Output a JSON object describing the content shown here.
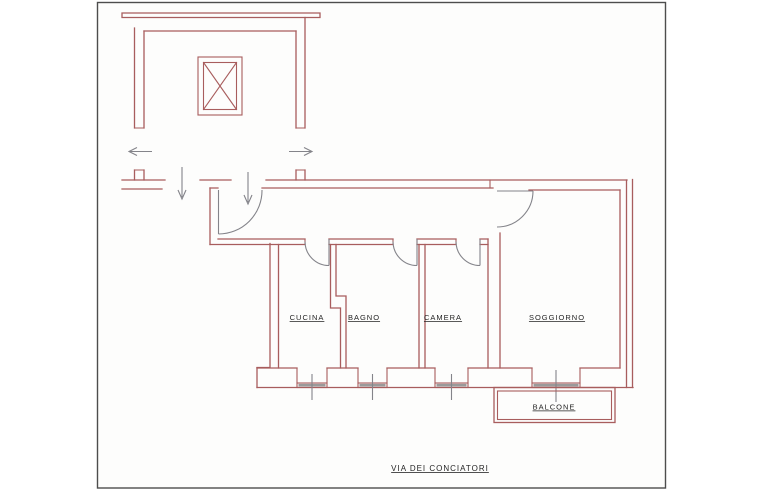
{
  "colors": {
    "paper": "#fdfdfc",
    "frame": "#4d4d4d",
    "wall": "#a85d5d",
    "fittings": "#84848a",
    "sill": "#9a9a9a",
    "label": "#252525"
  },
  "plan": {
    "title": "apartment floor plan",
    "rooms": [
      {
        "label": "CUCINA"
      },
      {
        "label": "BAGNO"
      },
      {
        "label": "CAMERA"
      },
      {
        "label": "SOGGIORNO"
      }
    ],
    "balcony_label": "BALCONE",
    "street_label": "VIA DEI CONCIATORI",
    "icons": [
      {
        "name": "elevator-shaft-icon",
        "glyph": "crossed-box"
      },
      {
        "name": "exit-arrow-left-icon",
        "glyph": "arrow-left"
      },
      {
        "name": "exit-arrow-right-icon",
        "glyph": "arrow-right"
      },
      {
        "name": "entry-arrow-icon",
        "glyph": "arrow-down"
      },
      {
        "name": "door-swing-icon",
        "glyph": "quarter-arc"
      },
      {
        "name": "window-sill-icon",
        "glyph": "hatched-band"
      }
    ]
  }
}
